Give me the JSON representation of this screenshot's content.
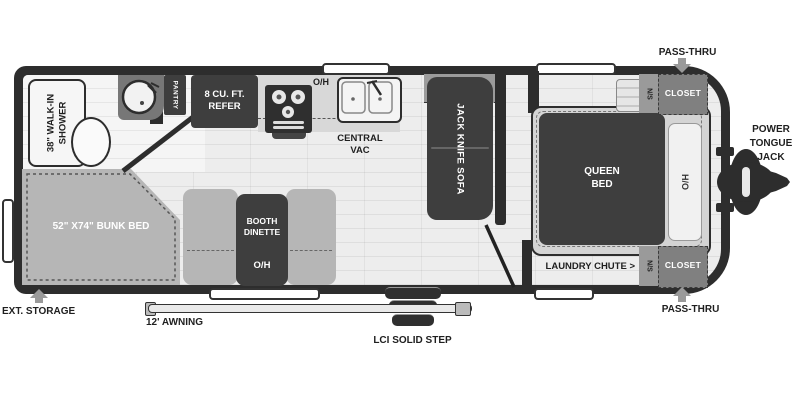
{
  "bathroom": {
    "shower_line1": "38\" WALK-IN",
    "shower_line2": "SHOWER",
    "pantry": "PANTRY"
  },
  "kitchen": {
    "refer_line1": "8 CU. FT.",
    "refer_line2": "REFER",
    "overhead": "O/H",
    "central_vac_line1": "CENTRAL",
    "central_vac_line2": "VAC"
  },
  "living_area": {
    "shelf": "SHELF",
    "sofa": "JACK KNIFE SOFA",
    "dinette_line1": "BOOTH",
    "dinette_line2": "DINETTE",
    "dinette_overhead": "O/H",
    "bunk": "52\" X74\" BUNK BED"
  },
  "bedroom": {
    "bed_line1": "QUEEN",
    "bed_line2": "BED",
    "headboard": "H/O",
    "nightstand_top": "N/S",
    "closet_top": "CLOSET",
    "nightstand_bottom": "N/S",
    "closet_bottom": "CLOSET",
    "laundry_chute": "LAUNDRY CHUTE >"
  },
  "exterior": {
    "pass_thru_top": "PASS-THRU",
    "pass_thru_bottom": "PASS-THRU",
    "ext_storage": "EXT. STORAGE",
    "awning": "12' AWNING",
    "step": "LCI SOLID STEP",
    "jack_line1": "POWER",
    "jack_line2": "TONGUE",
    "jack_line3": "JACK"
  },
  "colors": {
    "wall": "#2d2d2d",
    "floor": "#ececec",
    "dark_furniture": "#3e3e3e",
    "gray_furniture": "#b6b6b6",
    "annotation_arrow": "#9a9a9a",
    "label_dark": "#1f1f1f"
  }
}
